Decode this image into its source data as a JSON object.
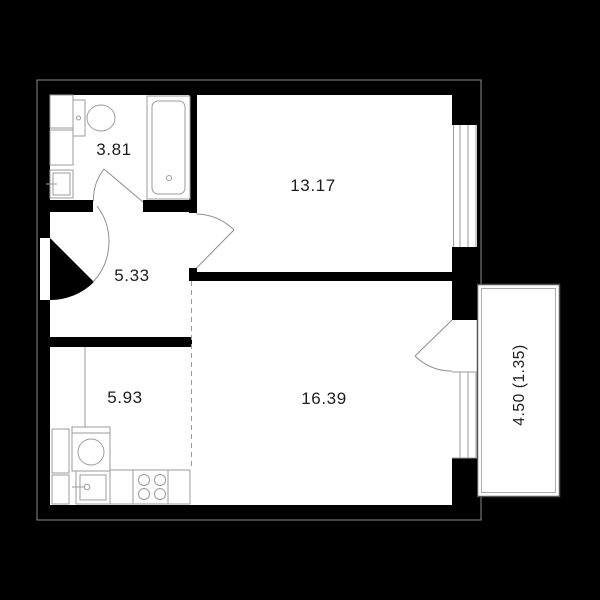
{
  "plan": {
    "title": "one-bedroom apartment floor plan",
    "rooms": [
      {
        "id": "bathroom",
        "area": "3.81"
      },
      {
        "id": "living-room",
        "area": "13.17"
      },
      {
        "id": "hallway",
        "area": "5.33"
      },
      {
        "id": "kitchen",
        "area": "5.93"
      },
      {
        "id": "bedroom",
        "area": "16.39"
      },
      {
        "id": "balcony",
        "area": "4.50 (1.35)"
      }
    ],
    "fixtures": [
      "toilet",
      "bathtub",
      "washbasin",
      "bathroom-cabinets",
      "washing-machine",
      "kitchen-sink",
      "stove",
      "kitchen-counter",
      "kitchen-cabinets"
    ],
    "colors": {
      "background": "#000000",
      "walls": "#000000",
      "floor": "#ffffff",
      "fixture_outline": "#9b9b9b",
      "label_text": "#1d1d1f"
    }
  }
}
